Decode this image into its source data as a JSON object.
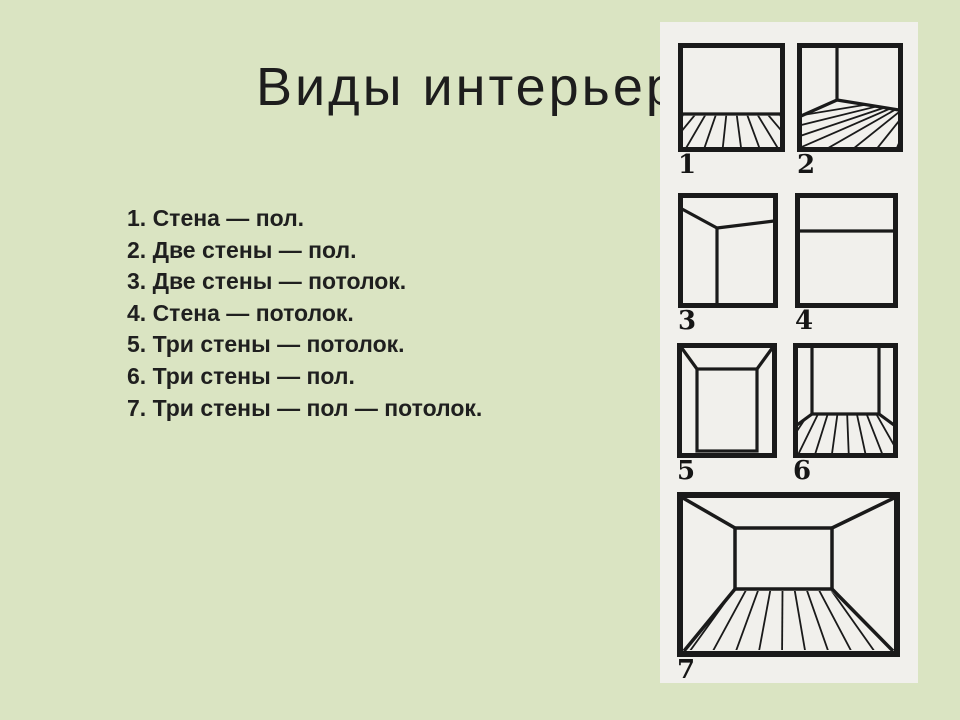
{
  "title": "Виды интерьера",
  "list": {
    "items": [
      "1. Стена — пол.",
      "2. Две стены — пол.",
      "3. Две стены — потолок.",
      "4. Стена — потолок.",
      "5. Три стены — потолок.",
      "6. Три стены — пол.",
      "7. Три стены — пол — потолок."
    ]
  },
  "panel": {
    "figures": [
      {
        "number": "1"
      },
      {
        "number": "2"
      },
      {
        "number": "3"
      },
      {
        "number": "4"
      },
      {
        "number": "5"
      },
      {
        "number": "6"
      },
      {
        "number": "7"
      }
    ]
  },
  "colors": {
    "background": "#dae4c2",
    "panel": "#f1f0ec",
    "ink": "#1a1a1a"
  }
}
